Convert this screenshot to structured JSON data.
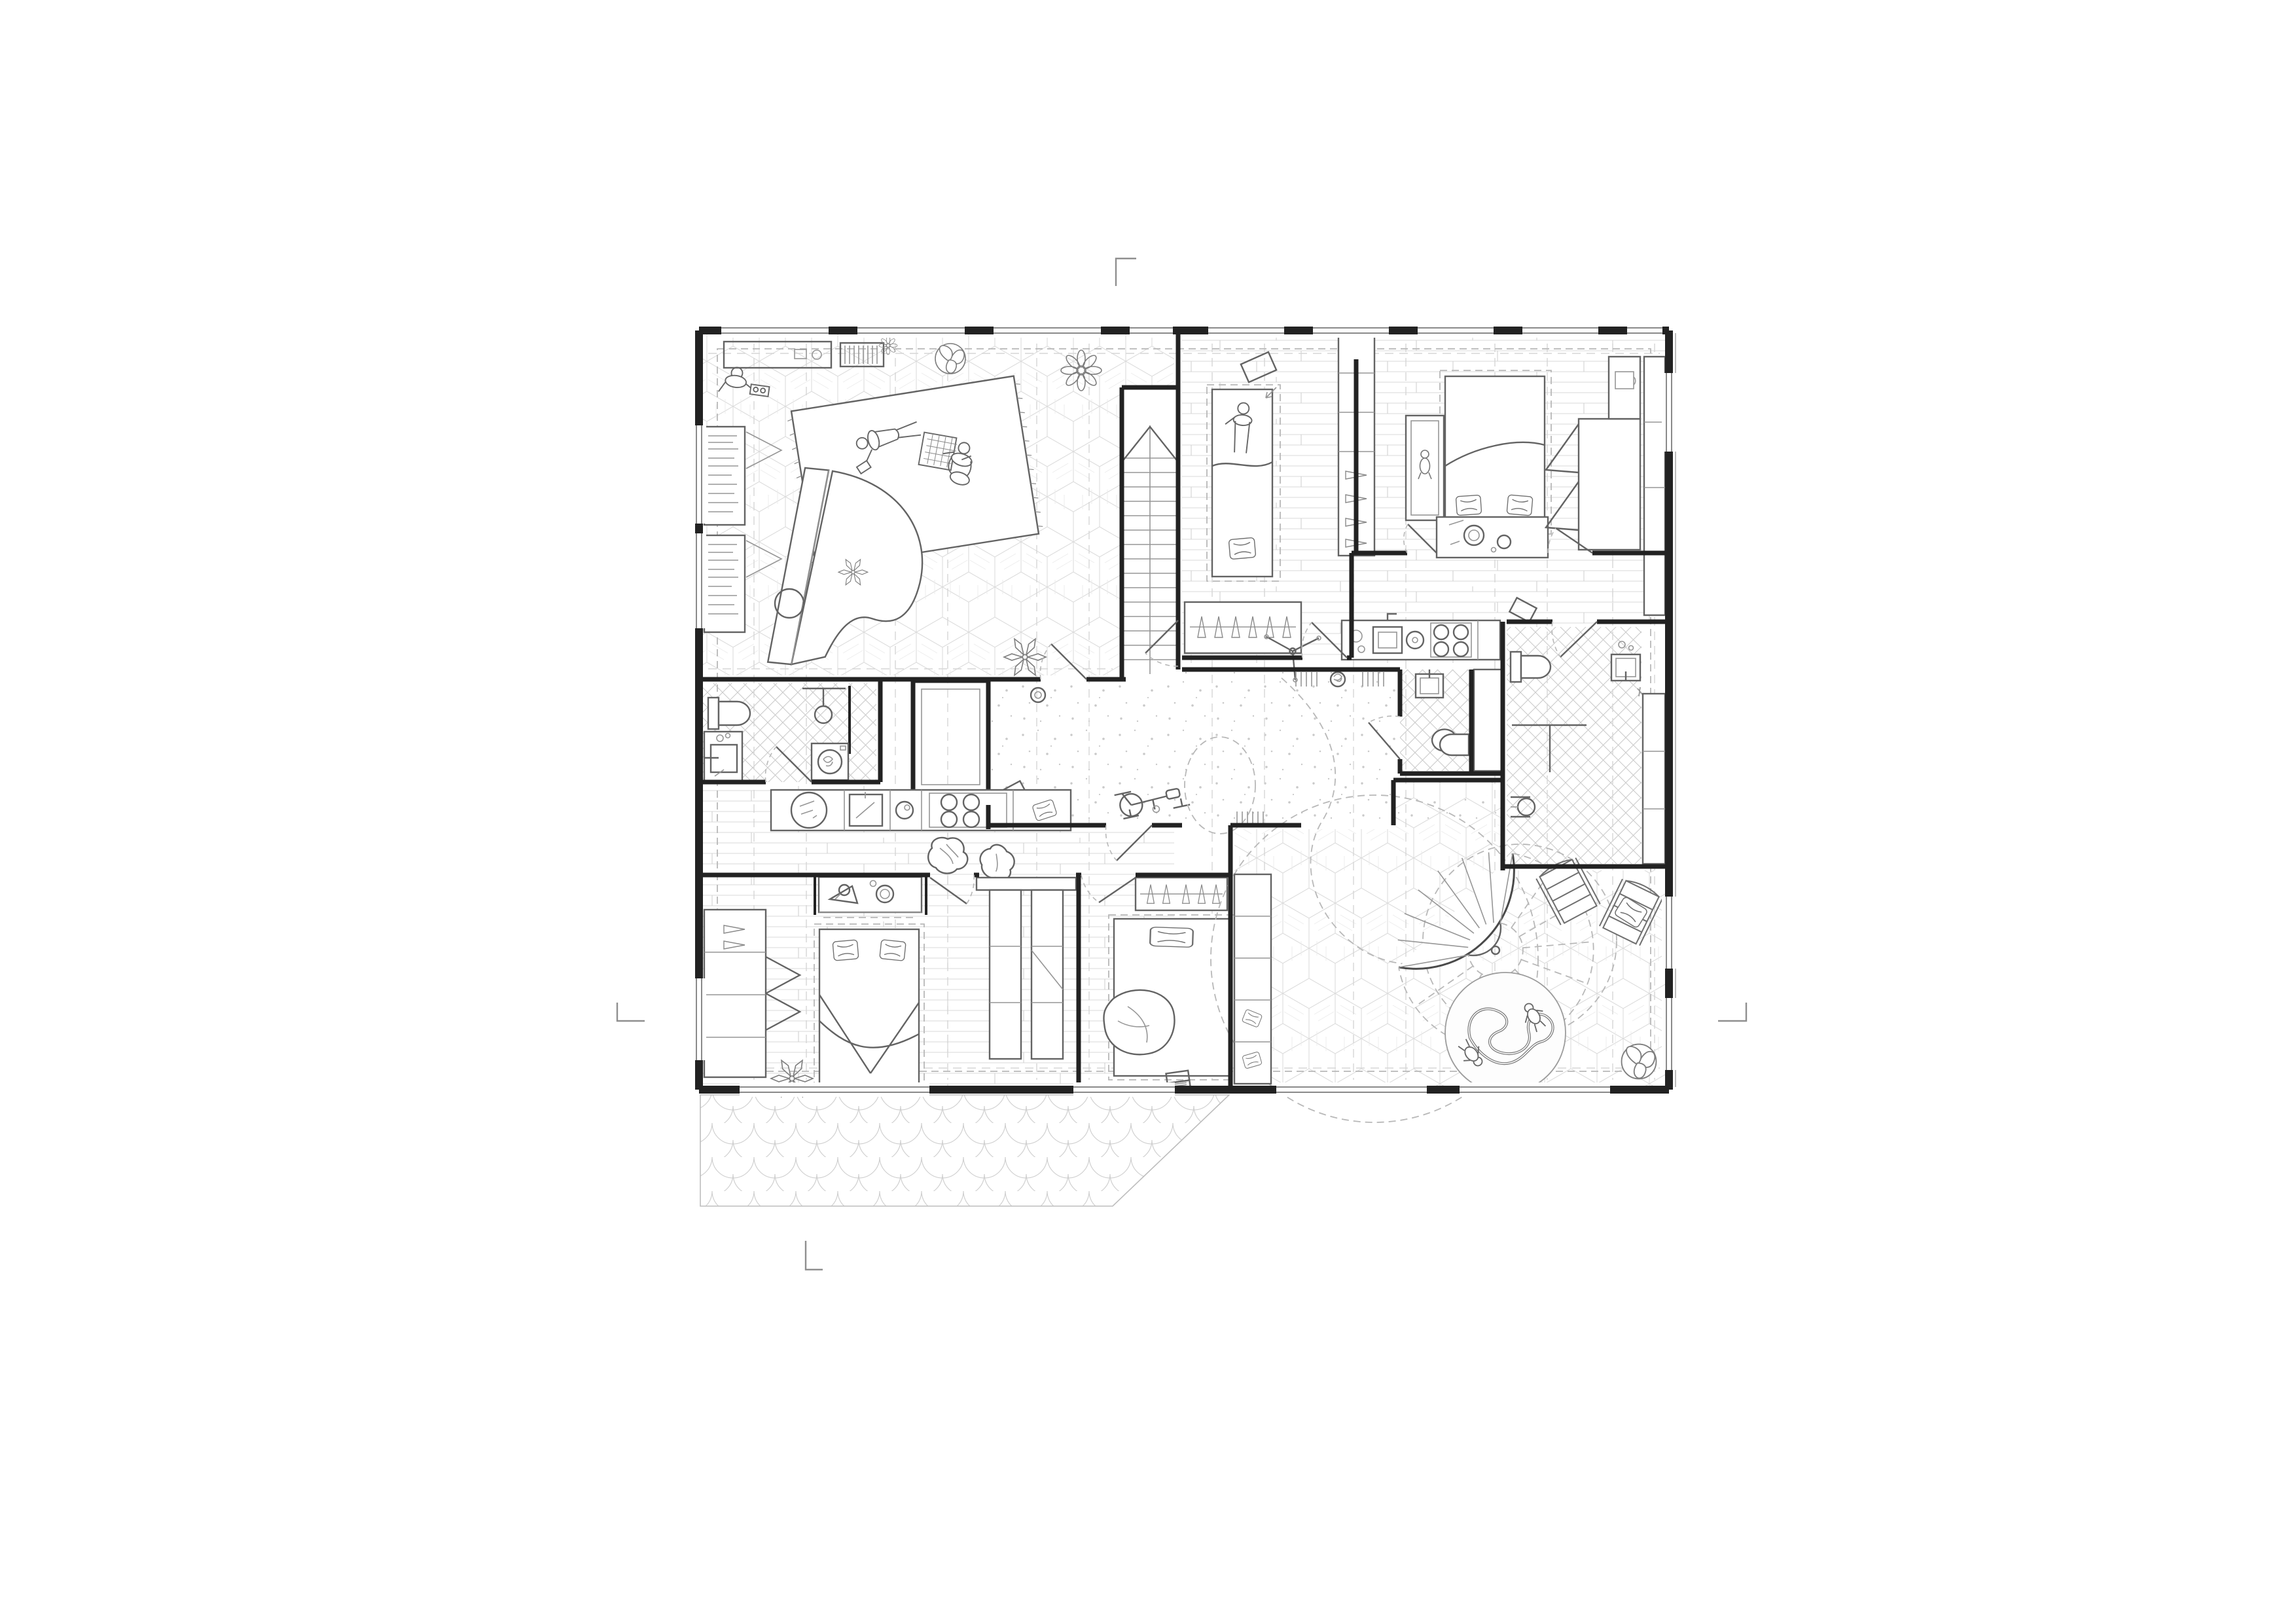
{
  "document": {
    "title_text": "Residential apartment floor plan — black and white architectural line drawing",
    "aria_label": "Floor plan drawing of a residential level with two apartments, central hall, staircases, bathrooms, bedrooms and a terrace",
    "sheet": {
      "background": "white",
      "visible_text": "none",
      "crop_marks": [
        "top-center",
        "left-middle",
        "right-middle",
        "bottom-left"
      ]
    }
  },
  "colors": {
    "paper": "#ffffff",
    "wall": "#222222",
    "furn": "#636363",
    "lite": "#969696",
    "dash": "#b8b8b8",
    "grid": "#d6d6d6",
    "pattern": "#dcdcdc"
  },
  "floor_patterns": [
    "isometric-cube-parquet",
    "wood-plank",
    "stipple-terrazzo",
    "tile-crosshatch",
    "fish-scale-paving"
  ],
  "rooms": [
    {
      "id": "living-music-room",
      "floor": "isometric-cube-parquet",
      "furniture": [
        "grand-piano",
        "piano-stool",
        "area-rug",
        "person-lying-with-phone",
        "person-kneeling-with-game-board",
        "person-standing-with-tray",
        "sideboard",
        "radiator",
        "bookcase",
        "bookcase",
        "flower-plant",
        "leaf-plant",
        "potted-plants"
      ]
    },
    {
      "id": "main-staircase",
      "floor": "none",
      "furniture": [
        "straight-two-flight-stair",
        "direction-chevron"
      ]
    },
    {
      "id": "bedroom-northeast-1",
      "floor": "wood-plank",
      "furniture": [
        "single-bed",
        "person-on-bed",
        "pillow",
        "wardrobe-with-hangers",
        "small-mat",
        "arrow-mark",
        "shelving-divider"
      ]
    },
    {
      "id": "bedroom-northeast-2",
      "floor": "wood-plank",
      "furniture": [
        "double-bed",
        "two-pillows",
        "baby-crib",
        "changing-dresser-with-basins",
        "open-wardrobe",
        "wall-cabinet"
      ]
    },
    {
      "id": "corridor-northeast",
      "floor": "wood-plank",
      "furniture": [
        "coat-stand",
        "kitchenette-counter",
        "sink",
        "four-burner-hob",
        "cutting-board",
        "wall-shelves",
        "picture-frame"
      ]
    },
    {
      "id": "central-hall",
      "floor": "stipple-terrazzo",
      "furniture": [
        "exercise-bike",
        "dashed-play-circle",
        "dashed-circulation-curve",
        "wall-slat-shelves",
        "flower-pot",
        "picture-frame",
        "vase"
      ]
    },
    {
      "id": "bathroom-west",
      "floor": "tile-crosshatch",
      "furniture": [
        "toilet",
        "vanity-sink",
        "shower-screen",
        "shower-head",
        "washing-machine"
      ]
    },
    {
      "id": "lift-shaft",
      "floor": "none",
      "furniture": [
        "double-lined-shaft"
      ]
    },
    {
      "id": "bathroom-east-small",
      "floor": "tile-crosshatch",
      "furniture": [
        "wall-sink",
        "toilet"
      ]
    },
    {
      "id": "bathroom-east-large",
      "floor": "tile-crosshatch",
      "furniture": [
        "toilet",
        "shower-rail",
        "wall-sink",
        "corner-sink",
        "storage-cabinets"
      ]
    },
    {
      "id": "kitchen-southwest",
      "floor": "wood-plank",
      "furniture": [
        "counter",
        "kitchen-scale",
        "cutting-board",
        "bowl",
        "four-burner-hob",
        "cushion"
      ]
    },
    {
      "id": "hall-southwest",
      "floor": "wood-plank",
      "furniture": [
        "crumpled-throw",
        "crumpled-throw",
        "vanity-alcove-with-mirror",
        "hanger-closet",
        "double-sided-closet"
      ]
    },
    {
      "id": "bedroom-southwest-1",
      "floor": "wood-plank",
      "furniture": [
        "double-bed",
        "two-pillows",
        "wardrobe-with-open-doors",
        "leaf-plant"
      ]
    },
    {
      "id": "bedroom-southwest-2",
      "floor": "wood-plank",
      "furniture": [
        "bed",
        "wide-pillow",
        "bean-bag",
        "laptop",
        "closet"
      ]
    },
    {
      "id": "playroom-southeast",
      "floor": "isometric-cube-parquet",
      "furniture": [
        "spiral-staircase",
        "dashed-swing-circles",
        "round-play-rug",
        "toy-train-track",
        "two-children",
        "deck-chair",
        "deck-chair-with-cushion",
        "leaf-plant",
        "shelf-column-with-pillows"
      ]
    },
    {
      "id": "terrace-patio",
      "floor": "fish-scale-paving",
      "furniture": []
    }
  ],
  "people_count": 6,
  "window_bays": {
    "north": 9,
    "south": 4,
    "west": 3,
    "east": 3
  }
}
